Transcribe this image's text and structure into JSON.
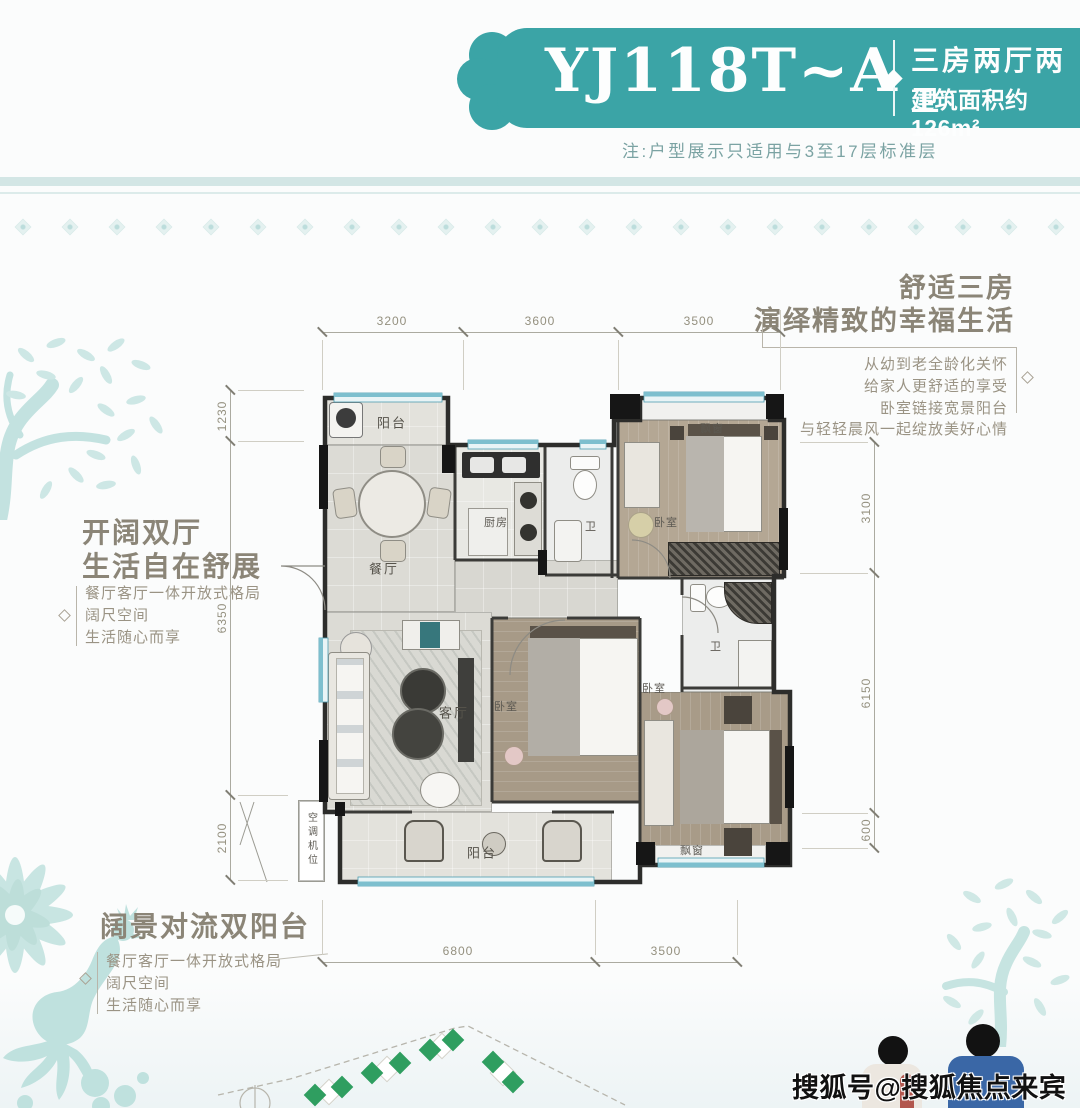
{
  "banner": {
    "title": "YJ118T~A",
    "subtitle_line1": "三房两厅两卫",
    "subtitle_line2": "建筑面积约126m²",
    "note": "注:户型展示只适用与3至17层标准层",
    "bg_color": "#3ba4a6"
  },
  "highlights": {
    "right": {
      "heading_line1": "舒适三房",
      "heading_line2": "演绎精致的幸福生活",
      "lines": [
        "从幼到老全龄化关怀",
        "给家人更舒适的享受",
        "卧室链接宽景阳台",
        "与轻轻晨风一起绽放美好心情"
      ]
    },
    "left": {
      "heading_line1": "开阔双厅",
      "heading_line2": "生活自在舒展",
      "lines": [
        "餐厅客厅一体开放式格局",
        "阔尺空间",
        "生活随心而享"
      ]
    },
    "bottom": {
      "heading_line1": "阔景对流双阳台",
      "lines": [
        "餐厅客厅一体开放式格局",
        "阔尺空间",
        "生活随心而享"
      ]
    }
  },
  "plan": {
    "labels": {
      "balcony_top": "阳台",
      "dining": "餐厅",
      "kitchen": "厨房",
      "bath_top": "卫",
      "bay_top": "飘窗",
      "bedroom_right": "卧室",
      "living": "客厅",
      "bedroom_mid": "卧室",
      "bath_right": "卫",
      "bedroom_bottom": "卧室",
      "bay_bottom": "飘窗",
      "balcony_bottom": "阳台",
      "ac_unit": "空调机位"
    },
    "dims": {
      "top": [
        "3200",
        "3600",
        "3500"
      ],
      "left": [
        "1230",
        "6350",
        "2100"
      ],
      "right": [
        "3100",
        "6150",
        "600"
      ],
      "bottom": [
        "6800",
        "3500"
      ]
    }
  },
  "watermark": {
    "text": "搜狐号@搜狐焦点来宾站"
  },
  "colors": {
    "banner_teal": "#3ba4a6",
    "deco_teal": "#cfe8e7",
    "site_green": "#2f9e60",
    "window_blue": "#7dbfce",
    "wall_dark": "#2d2d2b"
  }
}
